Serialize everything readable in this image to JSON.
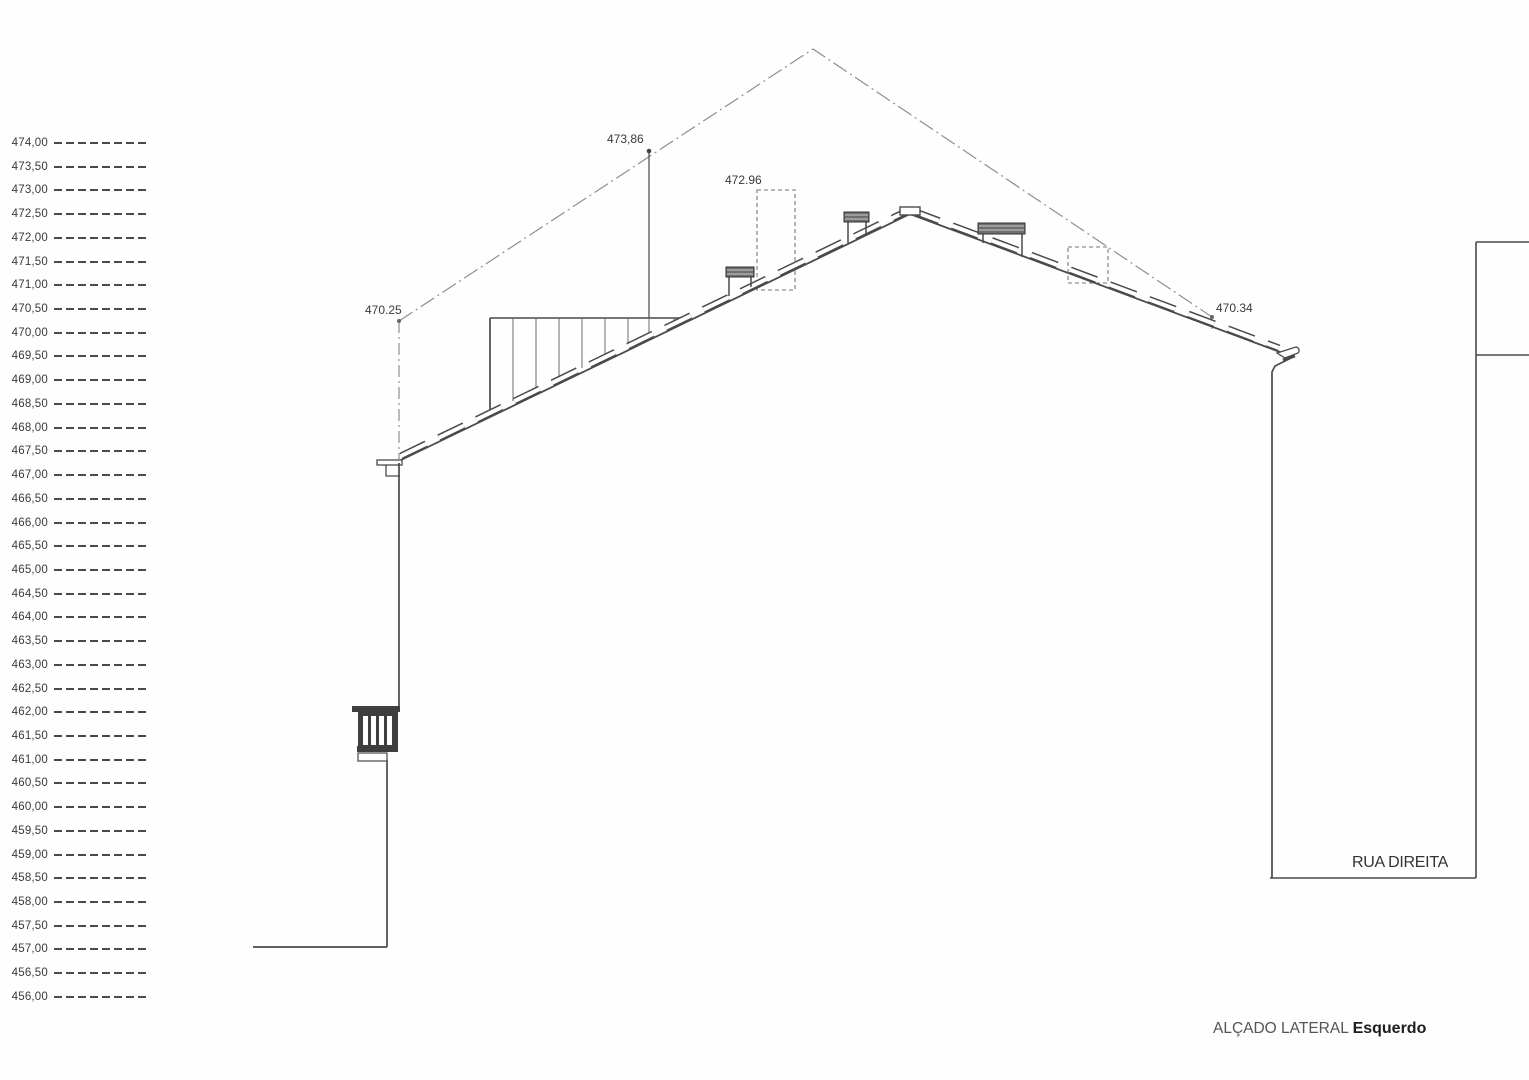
{
  "drawing": {
    "title": {
      "main": "ALÇADO LATERAL",
      "emphasis": "Esquerdo"
    },
    "street_label": "RUA DIREITA",
    "annotations": {
      "max_height": "473,86",
      "chimney_height": "472.96",
      "left_eave_height": "470.25",
      "right_eave_height": "470.34"
    },
    "elevation_scale": {
      "labels": [
        "474,00",
        "473,50",
        "473,00",
        "472,50",
        "472,00",
        "471,50",
        "471,00",
        "470,50",
        "470,00",
        "469,50",
        "469,00",
        "468,50",
        "468,00",
        "467,50",
        "467,00",
        "466,50",
        "466,00",
        "465,50",
        "465,00",
        "464,50",
        "464,00",
        "463,50",
        "463,00",
        "462,50",
        "462,00",
        "461,50",
        "461,00",
        "460,50",
        "460,00",
        "459,50",
        "459,00",
        "458,50",
        "458,00",
        "457,50",
        "457,00",
        "456,50",
        "456,00"
      ],
      "top_y": 143,
      "step_px": 23.72
    },
    "colors": {
      "line": "#4a4a4a",
      "light_line": "#8f8f8f",
      "text": "#3a3a3a",
      "dark_fill": "#3f3f3f",
      "background": "#fefefe"
    }
  }
}
